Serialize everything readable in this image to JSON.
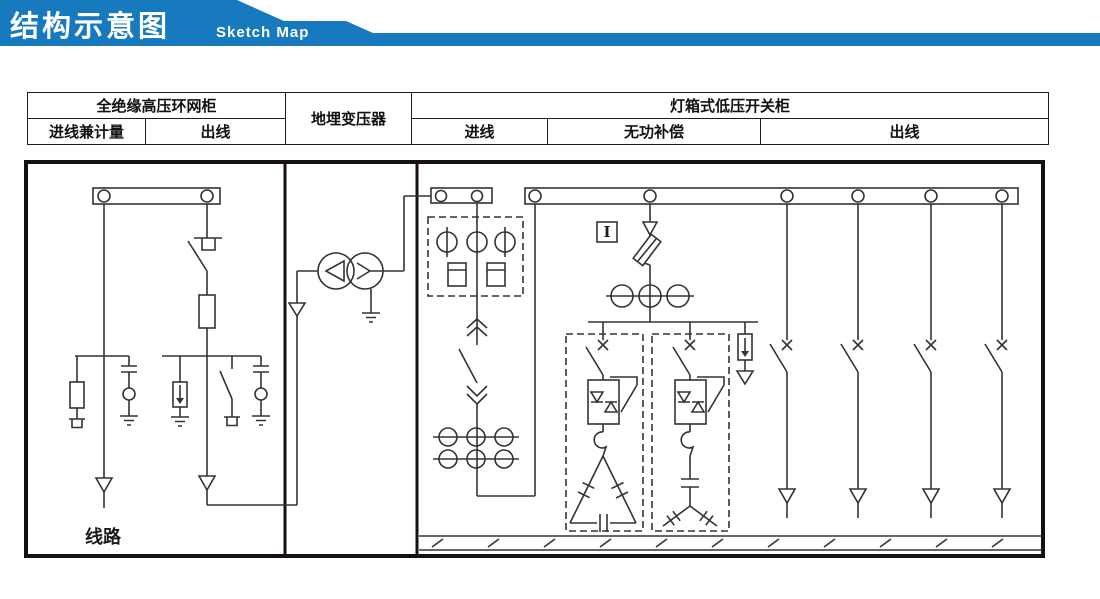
{
  "banner": {
    "title_cn": "结构示意图",
    "title_en": "Sketch Map",
    "bg_color": "#187abe"
  },
  "header_table": {
    "row1": {
      "hv_rmu": "全绝缘高压环网柜",
      "transformer": "地埋变压器",
      "lv_switchgear": "灯箱式低压开关柜"
    },
    "row2": {
      "incoming_metering": "进线兼计量",
      "hv_outgoing": "出线",
      "lv_incoming": "进线",
      "reactive_compensation": "无功补偿",
      "lv_outgoing": "出线"
    }
  },
  "diagram": {
    "line_label": "线路",
    "current_indicator_label": "I",
    "line_color": "#333333",
    "components": [
      "hv-busbar-with-taps",
      "cable-incoming-with-voltage-indicator-and-fuse-branch",
      "load-break-switch-with-fuse-outgoing",
      "surge-arrester-to-earth",
      "earthing-switch",
      "capacitive-voltage-indicator-lamp",
      "delta-wye-distribution-transformer-with-neutral-earth",
      "lv-incoming-busbar",
      "metering-unit-three-cts-two-energy-meters",
      "drawout-air-circuit-breaker",
      "current-transformer-bank-3x2",
      "lv-main-busbar-with-six-taps",
      "compensation-fuse-and-three-cts",
      "thyristor-switched-capacitor-branch-delta",
      "thyristor-switched-capacitor-branch-star",
      "lv-surge-arrester-branch",
      "four-outgoing-feeder-breakers",
      "earth-hatch-strip"
    ]
  }
}
